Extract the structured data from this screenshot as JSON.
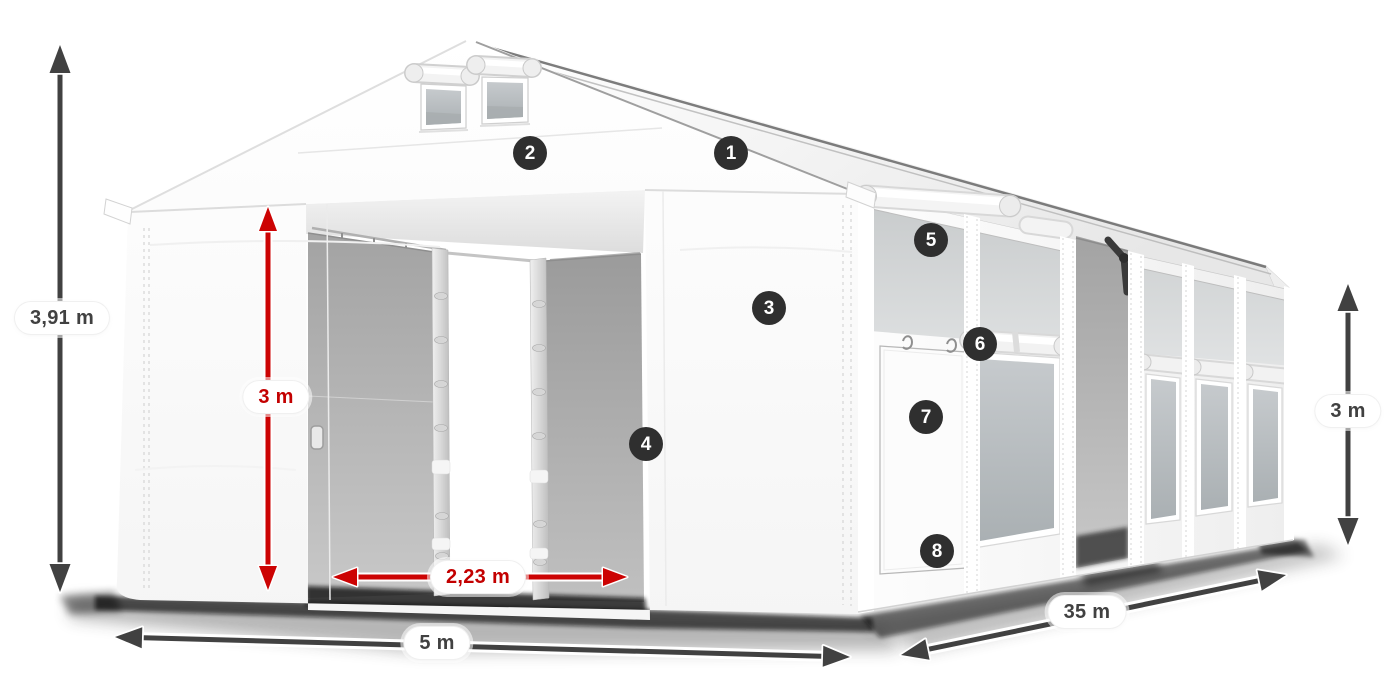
{
  "diagram": {
    "description": "White tent with dimension callouts and numbered hotspots",
    "markers": [
      {
        "number": "1"
      },
      {
        "number": "2"
      },
      {
        "number": "3"
      },
      {
        "number": "4"
      },
      {
        "number": "5"
      },
      {
        "number": "6"
      },
      {
        "number": "7"
      },
      {
        "number": "8"
      }
    ],
    "dimensions": {
      "total_height": {
        "label": "3,91 m",
        "color": "#414141",
        "orientation": "vertical"
      },
      "entrance_height": {
        "label": "3 m",
        "color": "#c30000",
        "orientation": "vertical"
      },
      "entrance_width": {
        "label": "2,23 m",
        "color": "#c30000",
        "orientation": "horizontal"
      },
      "front_width": {
        "label": "5 m",
        "color": "#414141",
        "orientation": "horizontal"
      },
      "side_length": {
        "label": "35 m",
        "color": "#414141",
        "orientation": "diagonal"
      },
      "side_height": {
        "label": "3 m",
        "color": "#414141",
        "orientation": "vertical"
      }
    },
    "colors": {
      "dimension_dark": "#414141",
      "dimension_red": "#cc0303",
      "marker_background": "#2f2f2f",
      "marker_text": "#ffffff",
      "tent_white": "#ffffff",
      "mesh_gray": "#b9bdc0",
      "label_background": "#ffffff"
    }
  }
}
